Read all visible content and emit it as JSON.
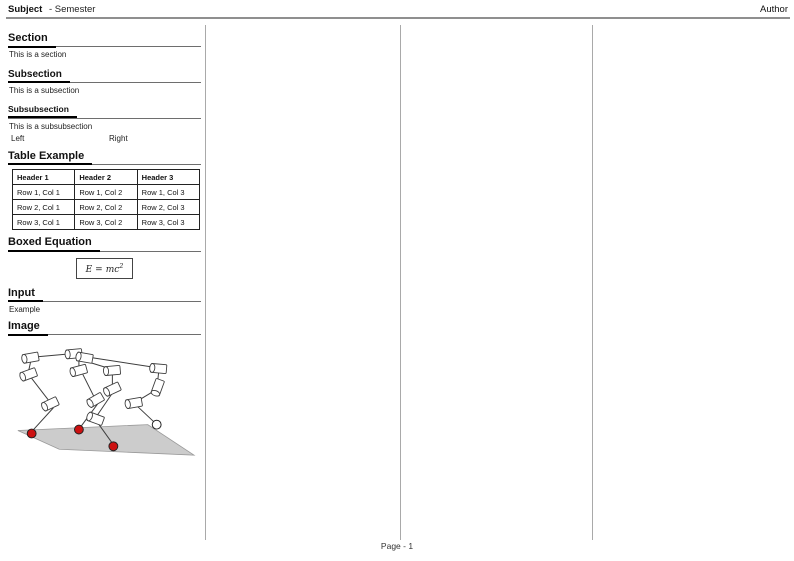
{
  "header": {
    "subject": "Subject",
    "semester": "- Semester",
    "author": "Author"
  },
  "footer": {
    "page_label": "Page - 1"
  },
  "column1": {
    "section": {
      "title": "Section",
      "body": "This is a section"
    },
    "subsection": {
      "title": "Subsection",
      "body": "This is a subsection"
    },
    "subsubsection": {
      "title": "Subsubsection",
      "body": "This is a subsubsection"
    },
    "columns_demo": {
      "left": "Left",
      "right": "Right"
    },
    "table_section": {
      "title": "Table Example",
      "table": {
        "headers": [
          "Header 1",
          "Header 2",
          "Header 3"
        ],
        "rows": [
          [
            "Row 1, Col 1",
            "Row 1, Col 2",
            "Row 1, Col 3"
          ],
          [
            "Row 2, Col 1",
            "Row 2, Col 2",
            "Row 2, Col 3"
          ],
          [
            "Row 3, Col 1",
            "Row 3, Col 2",
            "Row 3, Col 3"
          ]
        ]
      }
    },
    "equation_section": {
      "title": "Boxed Equation",
      "equation": {
        "lhs": "E",
        "rel": "=",
        "rhs": "mc",
        "exp": "2"
      }
    },
    "input_section": {
      "title": "Input",
      "body": "Example"
    },
    "image_section": {
      "title": "Image"
    }
  },
  "figure": {
    "colors": {
      "ground": "#cccccc",
      "ground_stroke": "#999999",
      "line": "#3d3d3d",
      "red": "#cc1111"
    },
    "ground": [
      [
        10,
        94
      ],
      [
        142,
        88
      ],
      [
        189,
        119
      ],
      [
        52,
        113
      ]
    ],
    "links": [
      [
        [
          30,
          19
        ],
        [
          64,
          16
        ]
      ],
      [
        [
          79,
          19
        ],
        [
          150,
          30
        ]
      ],
      [
        [
          77,
          23
        ],
        [
          103,
          31
        ]
      ],
      [
        [
          23,
          24
        ],
        [
          21,
          33
        ]
      ],
      [
        [
          72,
          22
        ],
        [
          72,
          30
        ]
      ],
      [
        [
          106,
          37
        ],
        [
          106,
          47
        ]
      ],
      [
        [
          153,
          35
        ],
        [
          152,
          44
        ]
      ],
      [
        [
          24,
          41
        ],
        [
          41,
          63
        ]
      ],
      [
        [
          46,
          71
        ],
        [
          25,
          94
        ]
      ],
      [
        [
          76,
          37
        ],
        [
          87,
          59
        ]
      ],
      [
        [
          91,
          67
        ],
        [
          74,
          90
        ]
      ],
      [
        [
          106,
          56
        ],
        [
          91,
          78
        ]
      ],
      [
        [
          91,
          86
        ],
        [
          106,
          107
        ]
      ],
      [
        [
          131,
          69
        ],
        [
          148,
          85
        ]
      ],
      [
        [
          148,
          54
        ],
        [
          133,
          63
        ]
      ]
    ],
    "cylinders": [
      {
        "x": 23,
        "y": 20,
        "a": -10
      },
      {
        "x": 67,
        "y": 16,
        "a": -5
      },
      {
        "x": 78,
        "y": 20,
        "a": 10
      },
      {
        "x": 21,
        "y": 37,
        "a": -20
      },
      {
        "x": 72,
        "y": 33,
        "a": -15
      },
      {
        "x": 106,
        "y": 33,
        "a": -5
      },
      {
        "x": 153,
        "y": 31,
        "a": 5
      },
      {
        "x": 106,
        "y": 52,
        "a": -25
      },
      {
        "x": 152,
        "y": 50,
        "a": -70
      },
      {
        "x": 89,
        "y": 63,
        "a": -30
      },
      {
        "x": 128,
        "y": 66,
        "a": -10
      },
      {
        "x": 43,
        "y": 67,
        "a": -25
      },
      {
        "x": 89,
        "y": 82,
        "a": 20
      }
    ],
    "feet": [
      {
        "x": 24,
        "y": 97,
        "color": "red"
      },
      {
        "x": 72,
        "y": 93,
        "color": "red"
      },
      {
        "x": 107,
        "y": 110,
        "color": "red"
      },
      {
        "x": 151,
        "y": 88,
        "color": "white"
      }
    ]
  }
}
